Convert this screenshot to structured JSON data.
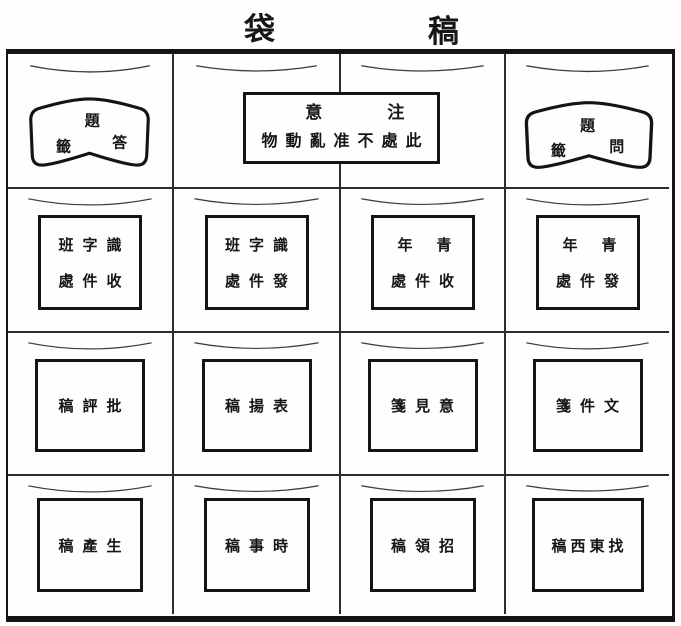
{
  "colors": {
    "ink": "#161616",
    "paper": "#fffefc"
  },
  "title": {
    "left_char": "袋",
    "right_char": "稿"
  },
  "row1": {
    "answer_tag": {
      "top": "題",
      "bottom_left": "籤",
      "bottom_right": "答"
    },
    "notice": {
      "line1_left": "意",
      "line1_right": "注",
      "line2": "物動亂准不處此"
    },
    "question_tag": {
      "top": "題",
      "bottom_left": "籤",
      "bottom_right": "問"
    }
  },
  "pockets": {
    "r2c1": {
      "line1": "班字識",
      "line2": "處件收"
    },
    "r2c2": {
      "line1": "班字識",
      "line2": "處件發"
    },
    "r2c3": {
      "line1": "年青",
      "line2": "處件收"
    },
    "r2c4": {
      "line1": "年青",
      "line2": "處件發"
    },
    "r3c1": {
      "line1": "稿評批"
    },
    "r3c2": {
      "line1": "稿揚表"
    },
    "r3c3": {
      "line1": "箋見意"
    },
    "r3c4": {
      "line1": "箋件文"
    },
    "r4c1": {
      "line1": "稿產生"
    },
    "r4c2": {
      "line1": "稿事時"
    },
    "r4c3": {
      "line1": "稿領招"
    },
    "r4c4": {
      "line1": "稿西東找"
    }
  }
}
